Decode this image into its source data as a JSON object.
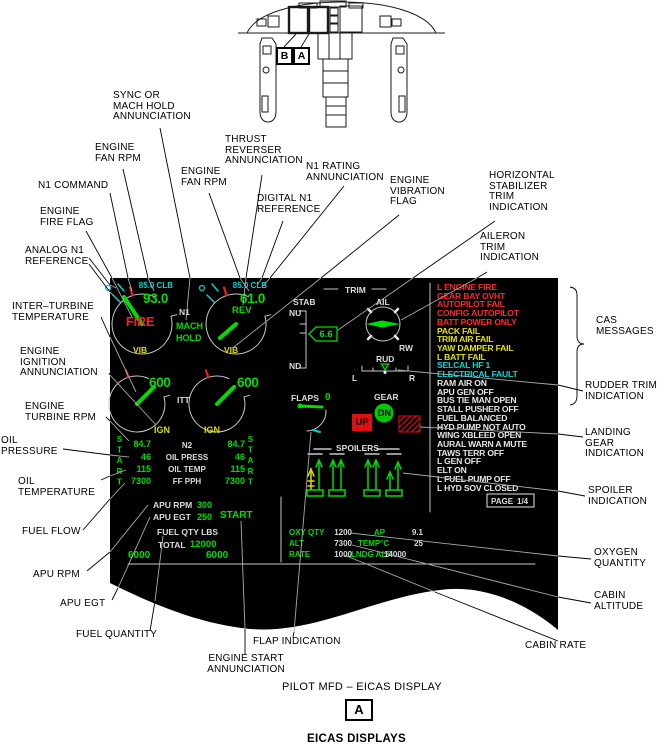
{
  "colors": {
    "green": "#00dc00",
    "cyan": "#00d2d2",
    "amber": "#dcdc00",
    "red": "#ff1e1e",
    "white": "#dcdcdc",
    "panel": "#000000"
  },
  "inset": {
    "marker_b": "B",
    "marker_a": "A"
  },
  "callouts": {
    "sync": "SYNC OR\nMACH HOLD\nANNUNCIATION",
    "engine_fan_rpm_1": "ENGINE\nFAN RPM",
    "n1_command": "N1 COMMAND",
    "engine_fire_flag": "ENGINE\nFIRE FLAG",
    "analog_n1": "ANALOG N1\nREFERENCE",
    "inter_turbine": "INTER–TURBINE\nTEMPERATURE",
    "engine_ignition": "ENGINE\nIGNITION\nANNUNCIATION",
    "engine_turbine_rpm": "ENGINE\nTURBINE RPM",
    "oil_pressure": "OIL\nPRESSURE",
    "oil_temperature": "OIL\nTEMPERATURE",
    "fuel_flow": "FUEL FLOW",
    "apu_rpm": "APU RPM",
    "apu_egt": "APU EGT",
    "fuel_quantity": "FUEL QUANTITY",
    "engine_start": "ENGINE START\nANNUNCIATION",
    "flap_indication": "FLAP INDICATION",
    "thrust_reverser": "THRUST\nREVERSER\nANNUNCIATION",
    "engine_fan_rpm_2": "ENGINE\nFAN RPM",
    "digital_n1": "DIGITAL N1\nREFERENCE",
    "n1_rating": "N1 RATING\nANNUNCIATION",
    "engine_vibration": "ENGINE\nVIBRATION\nFLAG",
    "horizontal_stab": "HORIZONTAL\nSTABILIZER\nTRIM\nINDICATION",
    "aileron_trim": "AILERON\nTRIM\nINDICATION",
    "cas_messages": "CAS\nMESSAGES",
    "rudder_trim": "RUDDER TRIM\nINDICATION",
    "landing_gear": "LANDING GEAR\nINDICATION",
    "spoiler_indication": "SPOILER\nINDICATION",
    "oxygen_quantity": "OXYGEN\nQUANTITY",
    "cabin_altitude": "CABIN\nALTITUDE",
    "cabin_rate": "CABIN RATE"
  },
  "display": {
    "engine_left": {
      "rating": "85.0 CLB",
      "n1": "93.0",
      "flag": "FIRE",
      "vib": "VIB",
      "itt": "600",
      "ign": "IGN",
      "start": "START",
      "n2": "84.7",
      "oil_press": "46",
      "oil_temp": "115",
      "fuel_flow": "7300"
    },
    "engine_right": {
      "rating": "85.0 CLB",
      "n1": "61.0",
      "flag": "REV",
      "vib": "VIB",
      "itt": "600",
      "ign": "IGN",
      "start": "START",
      "n2": "84.7",
      "oil_press": "46",
      "oil_temp": "115",
      "fuel_flow": "7300"
    },
    "labels": {
      "n1": "N1",
      "mach_hold": "MACH\nHOLD",
      "itt": "ITT",
      "n2": "N2",
      "oil_press": "OIL PRESS",
      "oil_temp": "OIL TEMP",
      "fuel_flow": "FF PPH"
    },
    "apu": {
      "rpm_label": "APU RPM",
      "rpm": "300",
      "egt_label": "APU EGT",
      "egt": "250",
      "start": "START"
    },
    "fuel": {
      "header": "FUEL QTY LBS",
      "total_label": "TOTAL",
      "total": "12000",
      "left": "6000",
      "right": "6000"
    },
    "trim": {
      "title": "TRIM",
      "stab_label": "STAB",
      "nu": "NU",
      "nd": "ND",
      "stab_value": "6.6",
      "ail_label": "AIL",
      "rw": "RW",
      "rud_label": "RUD",
      "left": "L",
      "right": "R"
    },
    "flaps": {
      "label": "FLAPS",
      "value": "0"
    },
    "gear": {
      "label": "GEAR",
      "up": "UP",
      "down": "DN"
    },
    "spoilers_label": "SPOILERS",
    "cabin": {
      "rows": [
        {
          "l1": "OXY QTY",
          "v1": "1200",
          "l2": "AP",
          "v2": "9.1"
        },
        {
          "l1": "ALT",
          "v1": "7300",
          "l2": "TEMP°C",
          "v2": "25"
        },
        {
          "l1": "RATE",
          "v1": "1000",
          "l2": "LNDG ALT",
          "v2": "14000"
        }
      ]
    },
    "cas": {
      "messages": [
        {
          "text": "L ENGINE FIRE",
          "level": "red"
        },
        {
          "text": "GEAR BAY OVHT",
          "level": "red"
        },
        {
          "text": "AUTOPILOT FAIL",
          "level": "red"
        },
        {
          "text": "CONFIG AUTOPILOT",
          "level": "red"
        },
        {
          "text": "BATT POWER ONLY",
          "level": "red"
        },
        {
          "text": "PACK FAIL",
          "level": "amber"
        },
        {
          "text": "TRIM AIR FAIL",
          "level": "amber"
        },
        {
          "text": "YAW DAMPER FAIL",
          "level": "amber"
        },
        {
          "text": "L BATT FAIL",
          "level": "amber"
        },
        {
          "text": "SELCAL HF 1",
          "level": "cyan"
        },
        {
          "text": "ELECTRICAL FAULT",
          "level": "cyan"
        },
        {
          "text": "RAM AIR ON",
          "level": "white"
        },
        {
          "text": "APU GEN OFF",
          "level": "white"
        },
        {
          "text": "BUS TIE MAN OPEN",
          "level": "white"
        },
        {
          "text": "STALL PUSHER OFF",
          "level": "white"
        },
        {
          "text": "FUEL BALANCED",
          "level": "white"
        },
        {
          "text": "HYD PUMP NOT AUTO",
          "level": "white"
        },
        {
          "text": "WING XBLEED OPEN",
          "level": "white"
        },
        {
          "text": "AURAL WARN A MUTE",
          "level": "white"
        },
        {
          "text": "TAWS TERR OFF",
          "level": "white"
        },
        {
          "text": "L GEN OFF",
          "level": "white"
        },
        {
          "text": "ELT ON",
          "level": "white"
        },
        {
          "text": "L FUEL PUMP OFF",
          "level": "white"
        },
        {
          "text": "L HYD SOV CLOSED",
          "level": "white"
        }
      ],
      "page_label": "PAGE",
      "page_number": "1/4"
    }
  },
  "footer": {
    "caption": "PILOT MFD – EICAS DISPLAY",
    "marker": "A",
    "title": "EICAS DISPLAYS"
  }
}
